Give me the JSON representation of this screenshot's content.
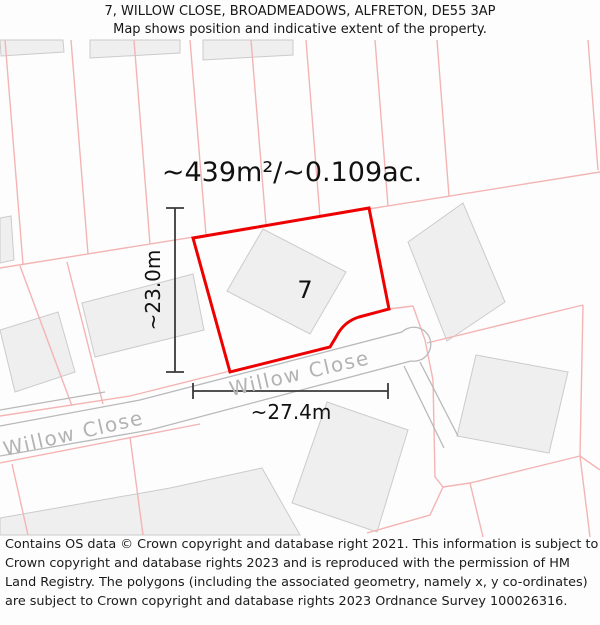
{
  "header": {
    "line1": "7, WILLOW CLOSE, BROADMEADOWS, ALFRETON, DE55 3AP",
    "line2": "Map shows position and indicative extent of the property."
  },
  "map": {
    "area_label": "~439m²/~0.109ac.",
    "plot_number": "7",
    "width_dimension": "~27.4m",
    "height_dimension": "~23.0m",
    "street_label_left": "Willow Close",
    "street_label_right": "Willow Close",
    "colors": {
      "property_outline": "#ee0000",
      "parcel_line": "#f4b4b4",
      "building_fill": "#efefef",
      "building_stroke": "#cbcbcb",
      "road_edge": "#b9b9b9",
      "street_label": "#b3b3b3",
      "dimension": "#3a3a3a",
      "label_text": "#111111",
      "background": "#fdfdfd"
    }
  },
  "footer": {
    "text": "Contains OS data © Crown copyright and database right 2021. This information is subject to Crown copyright and database rights 2023 and is reproduced with the permission of HM Land Registry. The polygons (including the associated geometry, namely x, y co-ordinates) are subject to Crown copyright and database rights 2023 Ordnance Survey 100026316."
  }
}
